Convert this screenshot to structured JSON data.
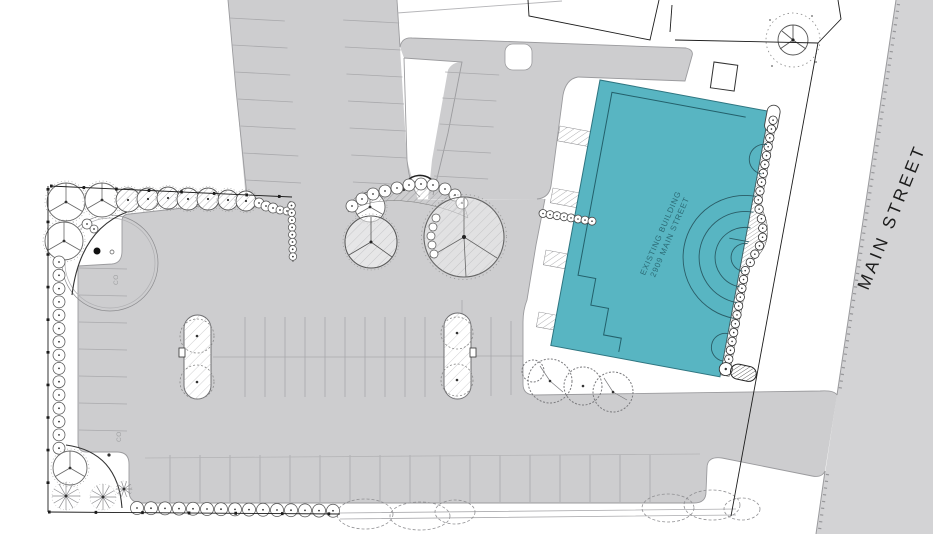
{
  "title": "Site Plan",
  "labels": {
    "street": "MAIN STREET",
    "cleanout_label": "CO"
  },
  "building": {
    "name_line": "EXISTING BUILDING",
    "address_line": "2909 MAIN STREET",
    "fill_color": "#58b5c2"
  },
  "colors": {
    "pavement": "#cdcdcf",
    "street_pavement": "#d3d3d5",
    "pavement_edge": "#9b9b9e",
    "stall_line": "#a9a9ac",
    "building_teal": "#58b5c2",
    "building_outline": "#2e7580",
    "building_text": "#2c6b76",
    "property_line": "#1c1c1c",
    "tree_line": "#666666"
  }
}
